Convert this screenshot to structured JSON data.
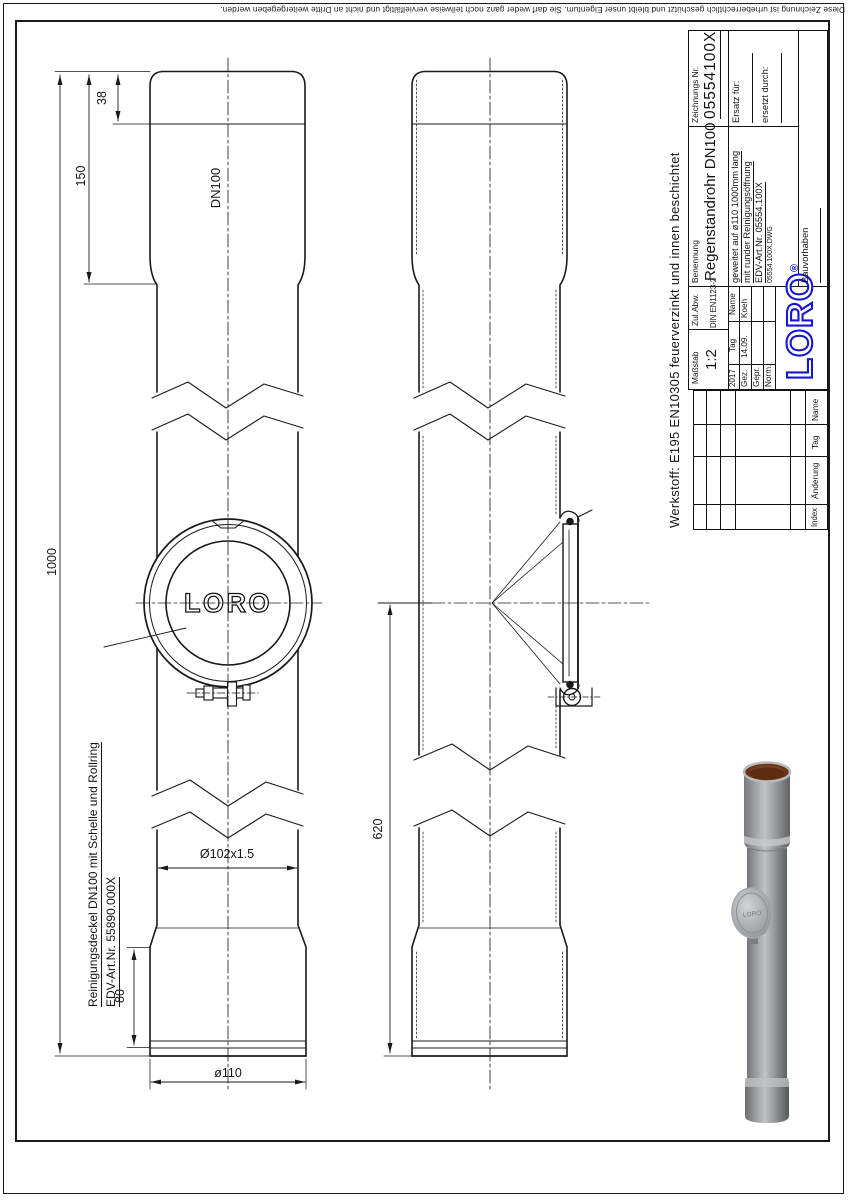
{
  "copyright": "Diese Zeichnung ist urheberrechtlich geschützt und bleibt unser Eigentum. Sie darf weder ganz noch teilweise vervielfältigt und nicht an Dritte weitergegeben werden.",
  "werkstoff": "Werkstoff: E195 EN10305 feuerverzinkt und innen beschichtet",
  "title_block": {
    "masstab_label": "Maßstab",
    "masstab_value": "1:2",
    "zulabw_label": "Zul.Abw.",
    "zulabw_value": "DIN EN1123-2",
    "benennung_label": "Benennung",
    "benennung_value": "Regenstandrohr DN100",
    "zeichnung_label": "Zeichnungs Nr.",
    "zeichnung_value": "05554100X",
    "desc_line1": "geweitet auf ø110 1000mm lang",
    "desc_line2": "mit runder Reinigungsöffnung",
    "desc_line3": "EDV-Art.Nr. 05554.100X",
    "desc_line4": "05554.100X.DWG",
    "ersatz_label": "Ersatz für:",
    "ersetzt_label": "ersetzt durch:",
    "year": "2017",
    "tag_label": "Tag",
    "name_label": "Name",
    "gez_label": "Gez.",
    "gez_tag": "14.09.",
    "gez_name": "Koeh",
    "gepr_label": "Gepr.",
    "norm_label": "Norm.",
    "bauvorhaben_label": "Bauvorhaben",
    "logo_text": "LORO",
    "logo_reg": "®"
  },
  "revision_table": {
    "index_label": "Index",
    "aenderung_label": "Änderung",
    "tag_label": "Tag",
    "name_label": "Name"
  },
  "dimensions": {
    "d38": "38",
    "d150": "150",
    "d1000": "1000",
    "dn100": "DN100",
    "d102": "Ø102x1.5",
    "d80": "80",
    "d110": "ø110",
    "d620": "620"
  },
  "callout": {
    "line1": "Reinigungsdeckel DN100 mit Schelle und Rollring",
    "line2": "EDV-Art.Nr. 55890.000X"
  },
  "drawing": {
    "cover_logo": "LORO",
    "photo_logo": "LORO"
  },
  "colors": {
    "logo_blue": "#1717d2",
    "line_black": "#1a1a1a",
    "pipe_gray": "#97999c",
    "socket_interior_brown": "#6b3416"
  }
}
